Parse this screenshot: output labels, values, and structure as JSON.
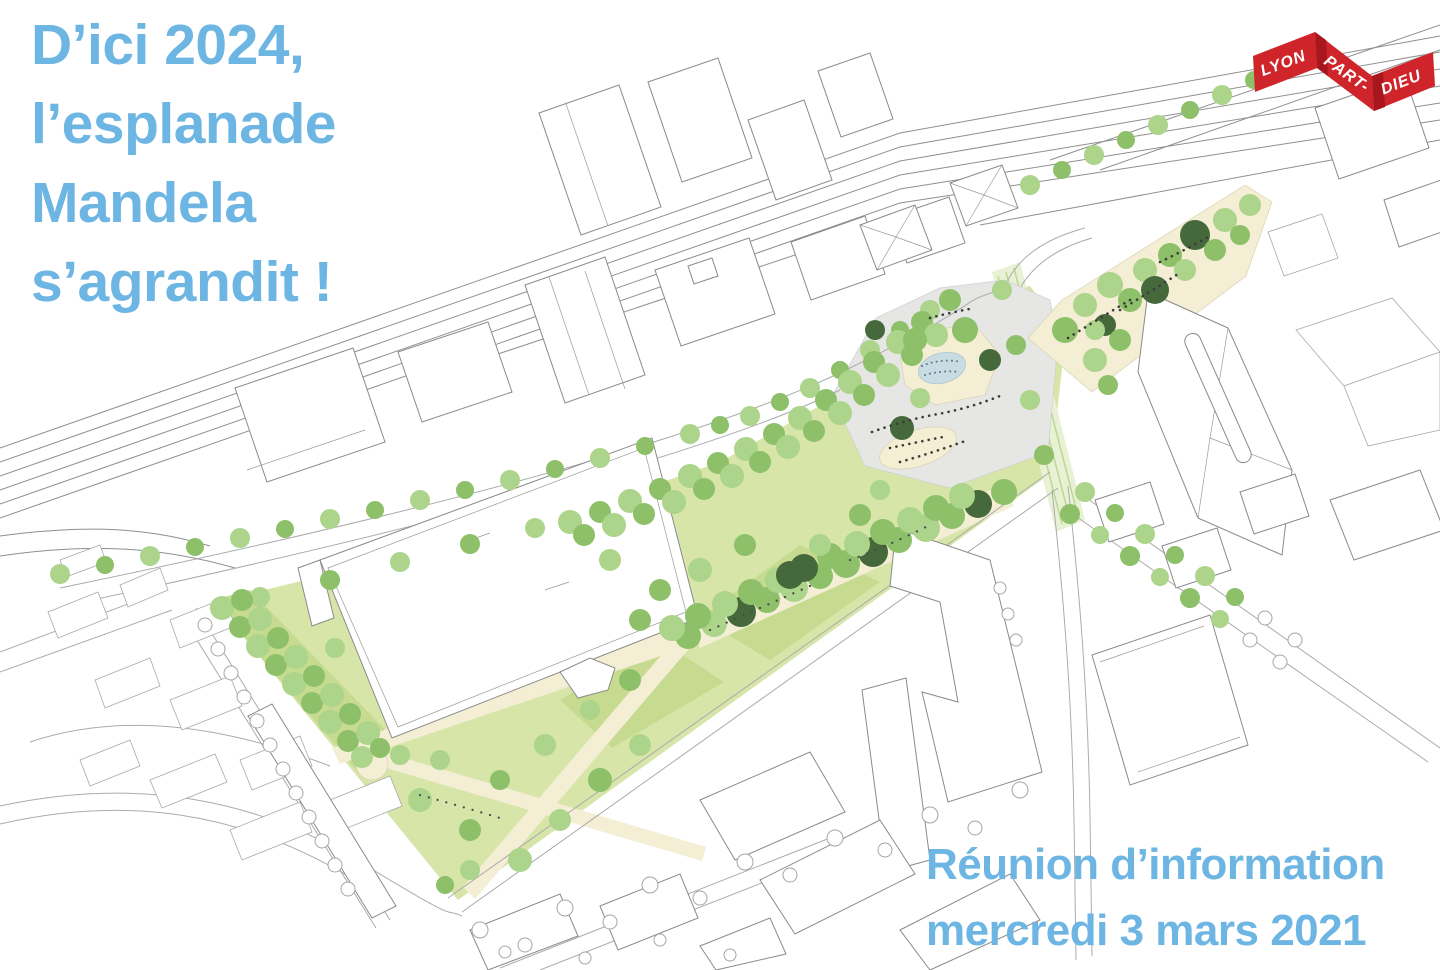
{
  "title": {
    "lines": [
      "D’ici 2024,",
      "l’esplanade",
      "Mandela",
      "s’agrandit !"
    ],
    "color": "#6db5e2"
  },
  "logo": {
    "name": "Lyon Part-Dieu",
    "words": [
      "LYON",
      "PART-",
      "DIEU"
    ],
    "ribbon_color": "#d0242b",
    "ribbon_shadow": "#a8171d",
    "text_color": "#ffffff"
  },
  "footer": {
    "lines": [
      "Réunion d’information",
      "mercredi 3 mars 2021"
    ],
    "color": "#6db5e2"
  },
  "illustration": {
    "palette": {
      "foliage_light": "#acd48a",
      "foliage_mid": "#8dc069",
      "foliage_dark": "#46693c",
      "lawn": "#d7e5a9",
      "lawn_shade": "#c6db90",
      "path_cream": "#f3eed4",
      "plaza_gray": "#e6e6e5",
      "pond_blue": "#c9dce3",
      "outline_gray": "#8f8f8f"
    }
  }
}
